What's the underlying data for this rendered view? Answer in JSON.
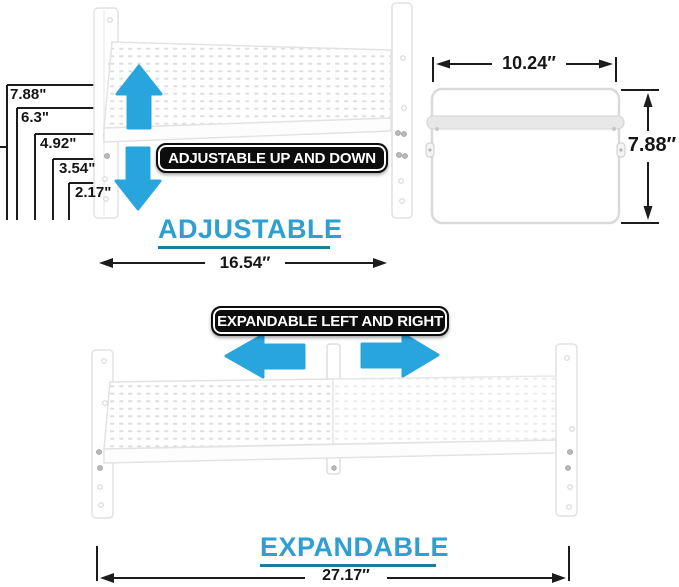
{
  "image_type": "product dimension diagram of an adjustable and expandable shelf organizer",
  "colors": {
    "background": "#ffffff",
    "arrow_blue": "#29a5de",
    "title_cyan": "#2d9fd2",
    "title_underline": "#1a7e99",
    "badge_background": "#0d0d0d",
    "badge_text": "#ffffff",
    "dimension_line": "#1c1c1c",
    "shelf_outline": "#e2e2e2"
  },
  "adjustable_section": {
    "title": "ADJUSTABLE",
    "badge": "ADJUSTABLE UP AND DOWN",
    "width_label": "16.54″",
    "height_labels": [
      "7.88\"",
      "6.3\"",
      "4.92\"",
      "3.54\"",
      "2.17\""
    ]
  },
  "side_view": {
    "width_label": "10.24″",
    "height_label": "7.88″"
  },
  "expandable_section": {
    "title": "EXPANDABLE",
    "badge": "EXPANDABLE LEFT AND RIGHT",
    "width_label": "27.17″"
  },
  "icons": {
    "up_arrow": "arrow-up",
    "down_arrow": "arrow-down",
    "left_arrow": "arrow-left",
    "right_arrow": "arrow-right"
  }
}
